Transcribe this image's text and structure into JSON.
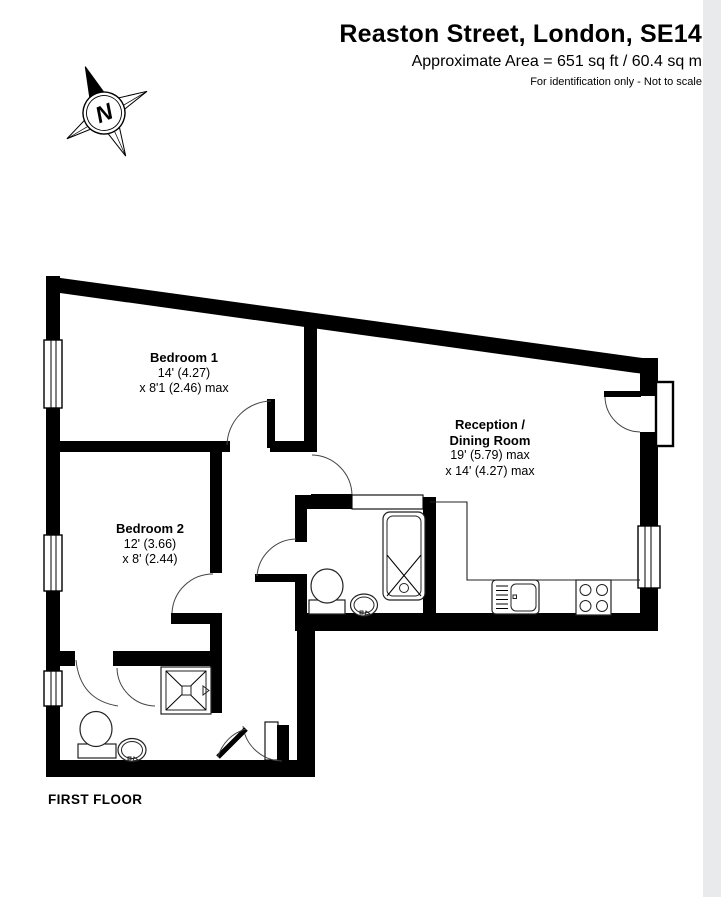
{
  "header": {
    "title": "Reaston Street, London, SE14",
    "area": "Approximate Area = 651 sq ft / 60.4 sq m",
    "note": "For identification only - Not to scale"
  },
  "compass": {
    "label": "N"
  },
  "plan": {
    "floor_label": "FIRST FLOOR",
    "wall_color": "#000000",
    "background_color": "#ffffff",
    "edge_strip_color": "#e8eaec",
    "rooms": [
      {
        "id": "bedroom-1",
        "name": "Bedroom 1",
        "dims": [
          "14' (4.27)",
          "x 8'1 (2.46) max"
        ]
      },
      {
        "id": "reception-dining",
        "name_lines": [
          "Reception /",
          "Dining Room"
        ],
        "dims": [
          "19' (5.79) max",
          "x 14' (4.27) max"
        ]
      },
      {
        "id": "bedroom-2",
        "name": "Bedroom 2",
        "dims": [
          "12' (3.66)",
          "x 8' (2.44)"
        ]
      }
    ],
    "fixtures": [
      "bath",
      "toilet",
      "wash-basin",
      "shower-tray",
      "kitchen-sink",
      "hob",
      "worktop"
    ]
  }
}
